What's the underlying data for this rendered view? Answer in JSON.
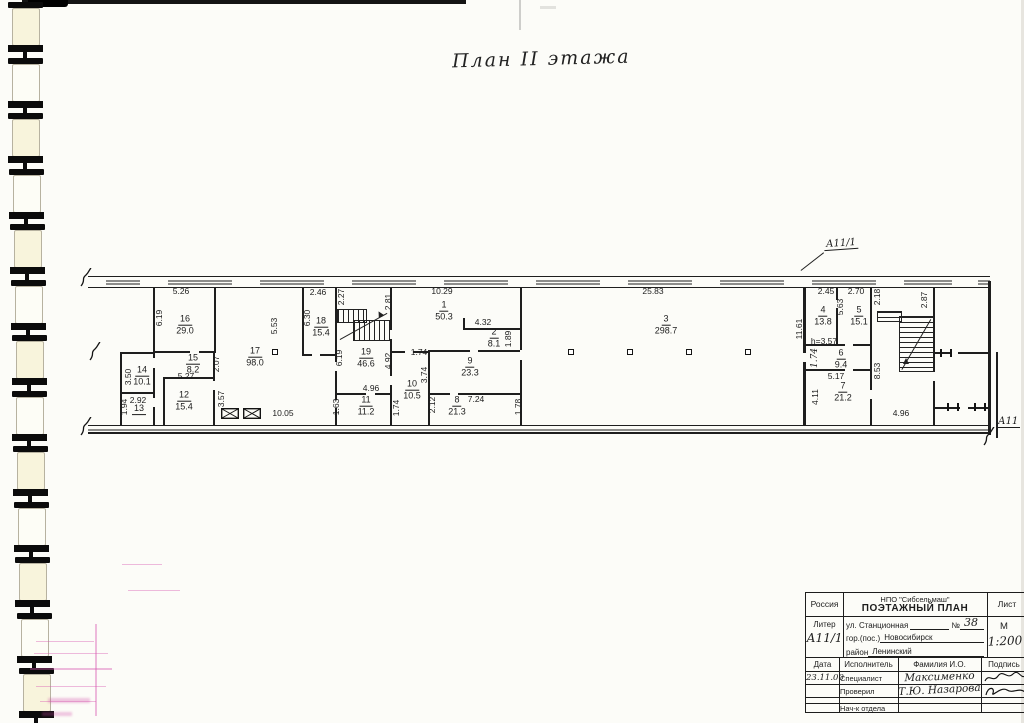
{
  "page": {
    "title": "План II этажа",
    "callout_top": "А11/1",
    "callout_bottom": "А11"
  },
  "plan": {
    "rooms": [
      {
        "n": "16",
        "a": "29.0",
        "x": 185,
        "y": 325
      },
      {
        "n": "17",
        "a": "98.0",
        "x": 255,
        "y": 357
      },
      {
        "n": "15",
        "a": "8.2",
        "x": 193,
        "y": 364
      },
      {
        "n": "14",
        "a": "10.1",
        "x": 142,
        "y": 376
      },
      {
        "n": "13",
        "a": "",
        "x": 139,
        "y": 409
      },
      {
        "n": "12",
        "a": "15.4",
        "x": 184,
        "y": 401
      },
      {
        "n": "18",
        "a": "15.4",
        "x": 321,
        "y": 327
      },
      {
        "n": "19",
        "a": "46.6",
        "x": 366,
        "y": 358
      },
      {
        "n": "11",
        "a": "11.2",
        "x": 366,
        "y": 406
      },
      {
        "n": "10",
        "a": "10.5",
        "x": 412,
        "y": 390
      },
      {
        "n": "1",
        "a": "50.3",
        "x": 444,
        "y": 311
      },
      {
        "n": "2",
        "a": "8.1",
        "x": 494,
        "y": 338
      },
      {
        "n": "9",
        "a": "23.3",
        "x": 470,
        "y": 367
      },
      {
        "n": "8",
        "a": "21.3",
        "x": 457,
        "y": 406
      },
      {
        "n": "3",
        "a": "298.7",
        "x": 666,
        "y": 325
      },
      {
        "n": "4",
        "a": "13.8",
        "x": 823,
        "y": 316
      },
      {
        "n": "5",
        "a": "15.1",
        "x": 859,
        "y": 316
      },
      {
        "n": "6",
        "a": "9.4",
        "x": 841,
        "y": 359
      },
      {
        "n": "7",
        "a": "21.2",
        "x": 843,
        "y": 392
      }
    ],
    "dims": [
      {
        "t": "5.26",
        "x": 181,
        "y": 291
      },
      {
        "t": "2.46",
        "x": 318,
        "y": 292
      },
      {
        "t": "10.29",
        "x": 442,
        "y": 291
      },
      {
        "t": "25.83",
        "x": 653,
        "y": 291
      },
      {
        "t": "2.45",
        "x": 826,
        "y": 291
      },
      {
        "t": "2.70",
        "x": 856,
        "y": 291
      },
      {
        "t": "6.19",
        "x": 159,
        "y": 318,
        "r": 1
      },
      {
        "t": "2.27",
        "x": 341,
        "y": 297,
        "r": 1
      },
      {
        "t": "2.81",
        "x": 388,
        "y": 302,
        "r": 1
      },
      {
        "t": "2.18",
        "x": 877,
        "y": 297,
        "r": 1
      },
      {
        "t": "2.87",
        "x": 924,
        "y": 300,
        "r": 1
      },
      {
        "t": "6.30",
        "x": 307,
        "y": 318,
        "r": 1
      },
      {
        "t": "5.53",
        "x": 274,
        "y": 326,
        "r": 1
      },
      {
        "t": "5.63",
        "x": 840,
        "y": 307,
        "r": 1
      },
      {
        "t": "11.61",
        "x": 799,
        "y": 329,
        "r": 1
      },
      {
        "t": "4.32",
        "x": 483,
        "y": 322
      },
      {
        "t": "1.89",
        "x": 508,
        "y": 339,
        "r": 1
      },
      {
        "t": "1.74",
        "x": 419,
        "y": 352
      },
      {
        "t": "6.19",
        "x": 339,
        "y": 358,
        "r": 1
      },
      {
        "t": "4.92",
        "x": 388,
        "y": 361,
        "r": 1
      },
      {
        "t": "2.07",
        "x": 216,
        "y": 364,
        "r": 1
      },
      {
        "t": "3.74",
        "x": 424,
        "y": 375,
        "r": 1
      },
      {
        "t": "h=3.57",
        "x": 824,
        "y": 341
      },
      {
        "t": "1.74",
        "x": 815,
        "y": 358,
        "r": 1,
        "hw": 1
      },
      {
        "t": "3.50",
        "x": 128,
        "y": 377,
        "r": 1
      },
      {
        "t": "5.27",
        "x": 186,
        "y": 376
      },
      {
        "t": "4.96",
        "x": 371,
        "y": 388
      },
      {
        "t": "5.17",
        "x": 836,
        "y": 376
      },
      {
        "t": "8.53",
        "x": 877,
        "y": 371,
        "r": 1
      },
      {
        "t": "2.92",
        "x": 138,
        "y": 400
      },
      {
        "t": "3.57",
        "x": 221,
        "y": 399,
        "r": 1
      },
      {
        "t": "7.24",
        "x": 476,
        "y": 399
      },
      {
        "t": "2.12",
        "x": 432,
        "y": 405,
        "r": 1
      },
      {
        "t": "1.94",
        "x": 124,
        "y": 407,
        "r": 1
      },
      {
        "t": "1.63",
        "x": 336,
        "y": 407,
        "r": 1
      },
      {
        "t": "1.74",
        "x": 396,
        "y": 408,
        "r": 1
      },
      {
        "t": "1.78",
        "x": 518,
        "y": 407,
        "r": 1
      },
      {
        "t": "4.11",
        "x": 815,
        "y": 397,
        "r": 1
      },
      {
        "t": "10.05",
        "x": 283,
        "y": 413
      },
      {
        "t": "4.96",
        "x": 901,
        "y": 413
      }
    ]
  },
  "titleblock": {
    "country": "Россия",
    "org": "НПО \"Сибсельмаш\"",
    "doc_type": "ПОЭТАЖНЫЙ ПЛАН",
    "sheet_label": "Лист",
    "liter_label": "Литер",
    "liter_value": "А11/1",
    "street_label": "ул. Станционная",
    "number_label": "№",
    "number_value": "38",
    "city_label": "гор.(пос.)",
    "city_value": "Новосибирск",
    "district_label": "район",
    "district_value": "Ленинский",
    "scale_label": "М",
    "scale_value": "1:200",
    "col_date": "Дата",
    "col_executor": "Исполнитель",
    "col_name": "Фамилия И.О.",
    "col_sign": "Подпись",
    "date_value": "23.11.00",
    "row1_role": "Специалист",
    "row1_name": "Максименко",
    "row2_role": "Проверил",
    "row2_name": "Т.Ю. Назарова",
    "row3_role": "Нач-к отдела"
  }
}
